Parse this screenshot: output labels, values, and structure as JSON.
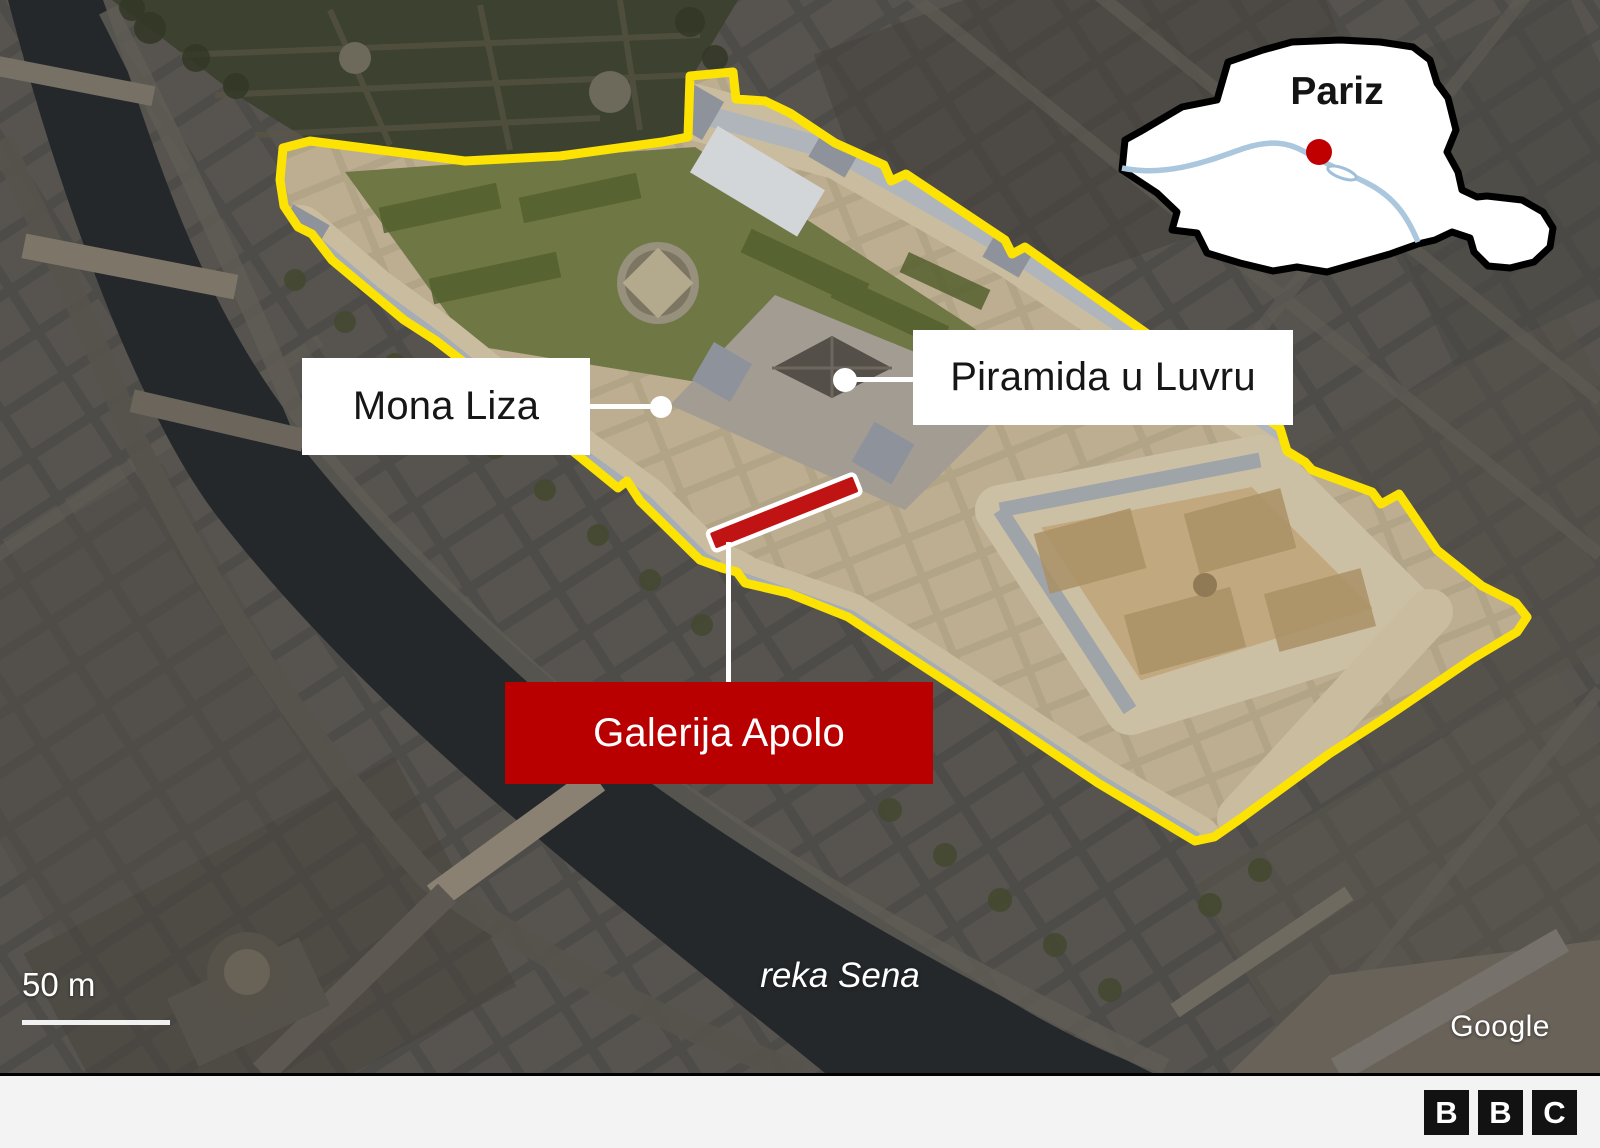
{
  "inset": {
    "city": "Pariz"
  },
  "annotations": {
    "mona_liza": {
      "label": "Mona Liza"
    },
    "pyramid": {
      "label": "Piramida u Luvru"
    },
    "apollo": {
      "label": "Galerija Apolo"
    }
  },
  "map_texts": {
    "river": "reka Sena",
    "scale": "50 m",
    "credit": "Google"
  },
  "footer": {
    "letters": [
      "B",
      "B",
      "C"
    ]
  },
  "colors": {
    "outline_yellow": "#fce303",
    "highlight_red": "#c01414",
    "label_red": "#b80000",
    "inset_river_blue": "#aac7de",
    "inset_marker_red": "#c00000"
  }
}
